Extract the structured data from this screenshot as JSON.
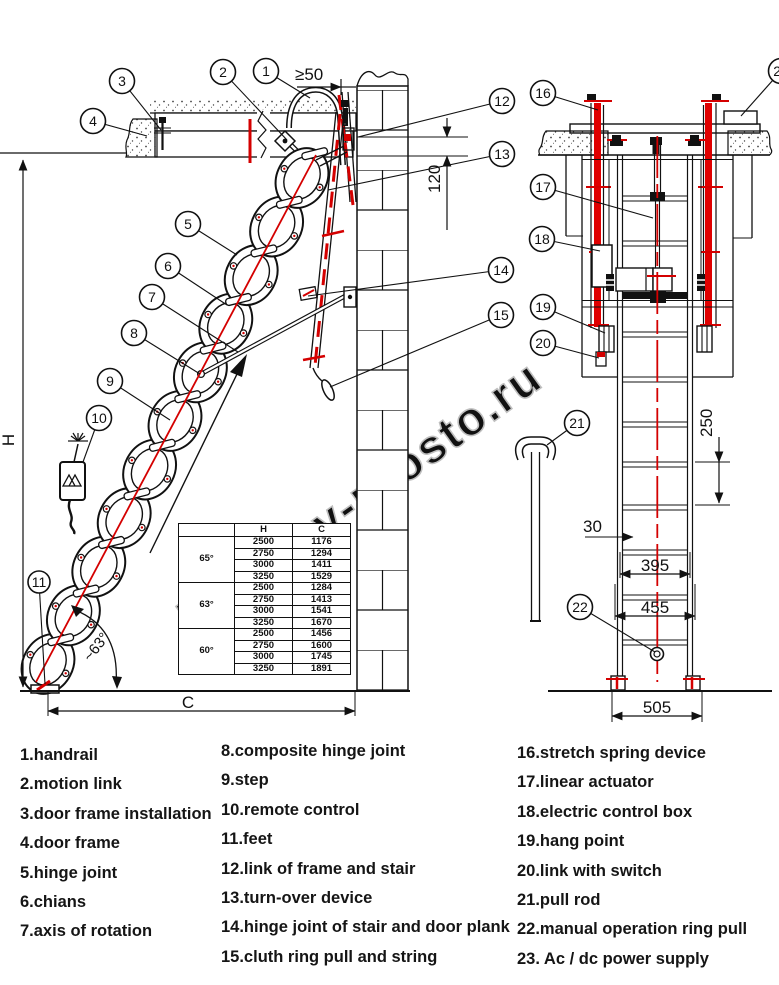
{
  "watermark": {
    "text": "lestnicy-prosto.ru",
    "color": "#bfbfbf"
  },
  "colors": {
    "line": "#111111",
    "accent_red": "#d40000",
    "spring_red": "#e00000"
  },
  "callouts": {
    "c1": "1",
    "c2": "2",
    "c3": "3",
    "c4": "4",
    "c5": "5",
    "c6": "6",
    "c7": "7",
    "c8": "8",
    "c9": "9",
    "c10": "10",
    "c11": "11",
    "c12": "12",
    "c13": "13",
    "c14": "14",
    "c15": "15",
    "c16": "16",
    "c17": "17",
    "c18": "18",
    "c19": "19",
    "c20": "20",
    "c21": "21",
    "c22": "22",
    "c23": "23"
  },
  "dims": {
    "gte50": "≥50",
    "d120": "120",
    "d250": "250",
    "d30": "30",
    "d395": "395",
    "d455": "455",
    "d505": "505",
    "h": "H",
    "c": "C",
    "angle": "~63°"
  },
  "table": {
    "headers": [
      "",
      "H",
      "C"
    ],
    "groups": [
      {
        "angle": "65°",
        "rows": [
          [
            "2500",
            "1176"
          ],
          [
            "2750",
            "1294"
          ],
          [
            "3000",
            "1411"
          ],
          [
            "3250",
            "1529"
          ]
        ]
      },
      {
        "angle": "63°",
        "rows": [
          [
            "2500",
            "1284"
          ],
          [
            "2750",
            "1413"
          ],
          [
            "3000",
            "1541"
          ],
          [
            "3250",
            "1670"
          ]
        ]
      },
      {
        "angle": "60°",
        "rows": [
          [
            "2500",
            "1456"
          ],
          [
            "2750",
            "1600"
          ],
          [
            "3000",
            "1745"
          ],
          [
            "3250",
            "1891"
          ]
        ]
      }
    ]
  },
  "legend": {
    "columns": [
      [
        "1.handrail",
        "2.motion link",
        "3.door frame installation",
        "4.door frame",
        "5.hinge joint",
        "6.chians",
        "7.axis of rotation"
      ],
      [
        "8.composite hinge joint",
        "9.step",
        "10.remote control",
        "11.feet",
        "12.link of frame and stair",
        "13.turn-over device",
        "14.hinge joint of stair and door plank",
        "15.cluth ring pull and string"
      ],
      [
        "16.stretch spring device",
        "17.linear actuator",
        "18.electric control box",
        "19.hang point",
        "20.link with switch",
        "21.pull rod",
        "22.manual operation ring pull",
        "23. Ac / dc power supply"
      ]
    ]
  }
}
